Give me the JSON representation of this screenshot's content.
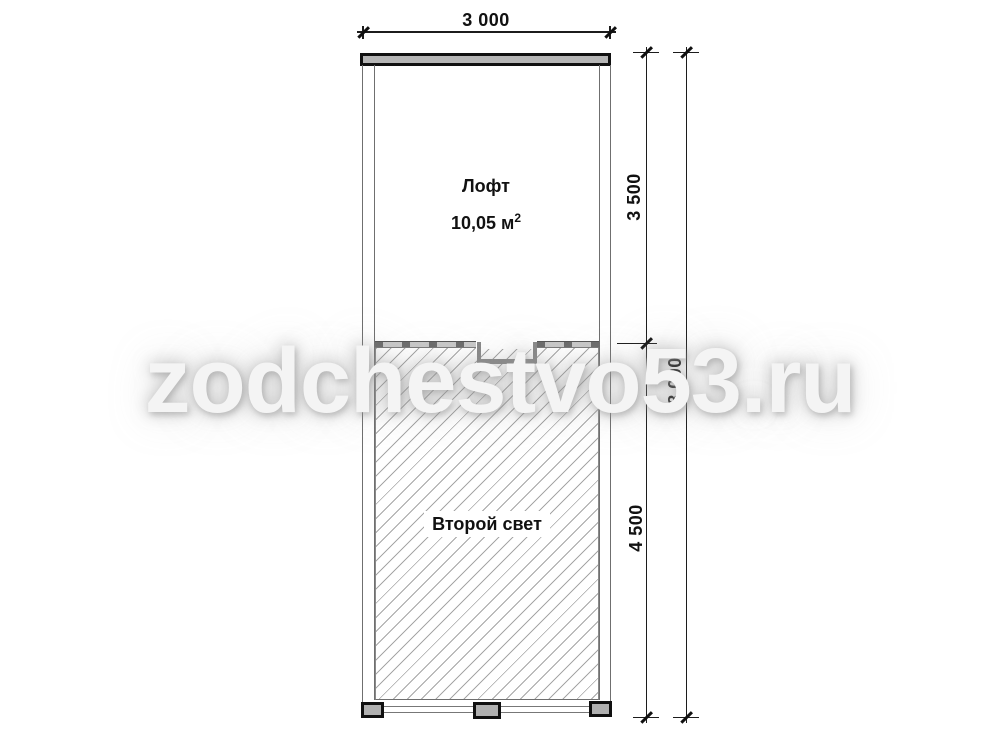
{
  "watermark": {
    "text": "zodchestvo53.ru"
  },
  "rooms": {
    "loft": {
      "name": "Лофт",
      "area_value": "10,05 м",
      "area_sup": "2"
    },
    "second_light": {
      "name": "Второй свет"
    }
  },
  "dimensions": {
    "width_top": "3 000",
    "height_upper": "3 500",
    "height_lower": "4 500",
    "height_total": "8 000"
  },
  "colors": {
    "wall_fill": "#b5b5b5",
    "footing_fill": "#b0b0b0",
    "dim_line": "#1c1c1c",
    "hatch_line": "#a6a6a6",
    "watermark_text": "#f4f4f4"
  }
}
